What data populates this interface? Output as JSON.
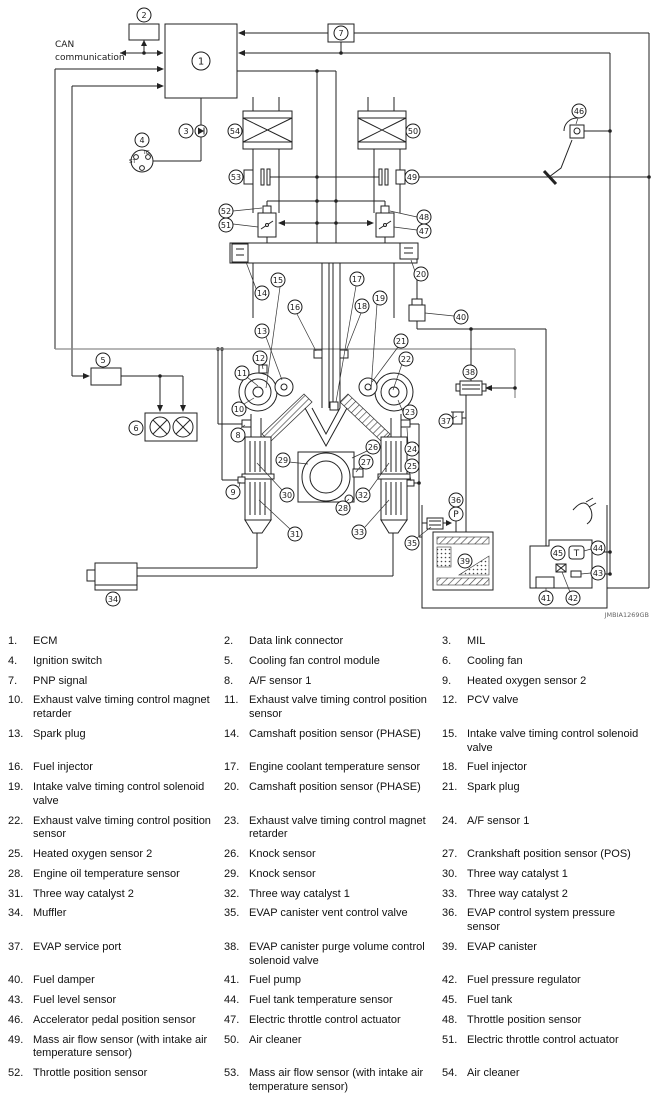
{
  "diagram": {
    "can_label_line1": "CAN",
    "can_label_line2": "communication",
    "ignition": {
      "ig": "IG",
      "st": "ST"
    },
    "pressure_sensor_letter": "P",
    "temp_sensor_letter": "T",
    "watermark": "JMBIA1269GB",
    "line_color": "#222222",
    "gray_line_color": "#8a8a8a",
    "callouts": {
      "c1": "1",
      "c2": "2",
      "c3": "3",
      "c4": "4",
      "c5": "5",
      "c6": "6",
      "c7": "7",
      "c8": "8",
      "c9": "9",
      "c10": "10",
      "c11": "11",
      "c12": "12",
      "c13": "13",
      "c14": "14",
      "c15": "15",
      "c16": "16",
      "c17": "17",
      "c18": "18",
      "c19": "19",
      "c20": "20",
      "c21": "21",
      "c22": "22",
      "c23": "23",
      "c24": "24",
      "c25": "25",
      "c26": "26",
      "c27": "27",
      "c28": "28",
      "c29": "29",
      "c30": "30",
      "c31": "31",
      "c32": "32",
      "c33": "33",
      "c34": "34",
      "c35": "35",
      "c36": "36",
      "c37": "37",
      "c38": "38",
      "c39": "39",
      "c40": "40",
      "c41": "41",
      "c42": "42",
      "c43": "43",
      "c44": "44",
      "c45": "45",
      "c46": "46",
      "c47": "47",
      "c48": "48",
      "c49": "49",
      "c50": "50",
      "c51": "51",
      "c52": "52",
      "c53": "53",
      "c54": "54"
    }
  },
  "legend": {
    "items": [
      {
        "num": "1.",
        "label": "ECM"
      },
      {
        "num": "2.",
        "label": "Data link connector"
      },
      {
        "num": "3.",
        "label": "MIL"
      },
      {
        "num": "4.",
        "label": "Ignition switch"
      },
      {
        "num": "5.",
        "label": "Cooling fan control module"
      },
      {
        "num": "6.",
        "label": "Cooling fan"
      },
      {
        "num": "7.",
        "label": "PNP signal"
      },
      {
        "num": "8.",
        "label": "A/F sensor 1"
      },
      {
        "num": "9.",
        "label": "Heated oxygen sensor 2"
      },
      {
        "num": "10.",
        "label": "Exhaust valve timing control magnet retarder"
      },
      {
        "num": "11.",
        "label": "Exhaust valve timing control position sensor"
      },
      {
        "num": "12.",
        "label": "PCV valve"
      },
      {
        "num": "13.",
        "label": "Spark plug"
      },
      {
        "num": "14.",
        "label": "Camshaft position sensor (PHASE)"
      },
      {
        "num": "15.",
        "label": "Intake valve timing control solenoid valve"
      },
      {
        "num": "16.",
        "label": "Fuel injector"
      },
      {
        "num": "17.",
        "label": "Engine coolant temperature sensor"
      },
      {
        "num": "18.",
        "label": "Fuel injector"
      },
      {
        "num": "19.",
        "label": "Intake valve timing control solenoid valve"
      },
      {
        "num": "20.",
        "label": "Camshaft position sensor (PHASE)"
      },
      {
        "num": "21.",
        "label": "Spark plug"
      },
      {
        "num": "22.",
        "label": "Exhaust valve timing control position sensor"
      },
      {
        "num": "23.",
        "label": "Exhaust valve timing control magnet retarder"
      },
      {
        "num": "24.",
        "label": "A/F sensor 1"
      },
      {
        "num": "25.",
        "label": "Heated oxygen sensor 2"
      },
      {
        "num": "26.",
        "label": "Knock sensor"
      },
      {
        "num": "27.",
        "label": "Crankshaft position sensor (POS)"
      },
      {
        "num": "28.",
        "label": "Engine oil temperature sensor"
      },
      {
        "num": "29.",
        "label": "Knock sensor"
      },
      {
        "num": "30.",
        "label": "Three way catalyst 1"
      },
      {
        "num": "31.",
        "label": "Three way catalyst 2"
      },
      {
        "num": "32.",
        "label": "Three way catalyst 1"
      },
      {
        "num": "33.",
        "label": "Three way catalyst 2"
      },
      {
        "num": "34.",
        "label": "Muffler"
      },
      {
        "num": "35.",
        "label": "EVAP canister vent control valve"
      },
      {
        "num": "36.",
        "label": "EVAP control system pressure sensor"
      },
      {
        "num": "37.",
        "label": "EVAP service port"
      },
      {
        "num": "38.",
        "label": "EVAP canister purge volume control solenoid valve"
      },
      {
        "num": "39.",
        "label": "EVAP canister"
      },
      {
        "num": "40.",
        "label": "Fuel damper"
      },
      {
        "num": "41.",
        "label": "Fuel pump"
      },
      {
        "num": "42.",
        "label": "Fuel pressure regulator"
      },
      {
        "num": "43.",
        "label": "Fuel level sensor"
      },
      {
        "num": "44.",
        "label": "Fuel tank temperature sensor"
      },
      {
        "num": "45.",
        "label": "Fuel tank"
      },
      {
        "num": "46.",
        "label": "Accelerator pedal position sensor"
      },
      {
        "num": "47.",
        "label": "Electric throttle control actuator"
      },
      {
        "num": "48.",
        "label": "Throttle position sensor"
      },
      {
        "num": "49.",
        "label": "Mass air flow sensor (with intake air temperature sensor)"
      },
      {
        "num": "50.",
        "label": "Air cleaner"
      },
      {
        "num": "51.",
        "label": "Electric throttle control actuator"
      },
      {
        "num": "52.",
        "label": "Throttle position sensor"
      },
      {
        "num": "53.",
        "label": "Mass air flow sensor (with intake air temperature sensor)"
      },
      {
        "num": "54.",
        "label": "Air cleaner"
      }
    ]
  }
}
